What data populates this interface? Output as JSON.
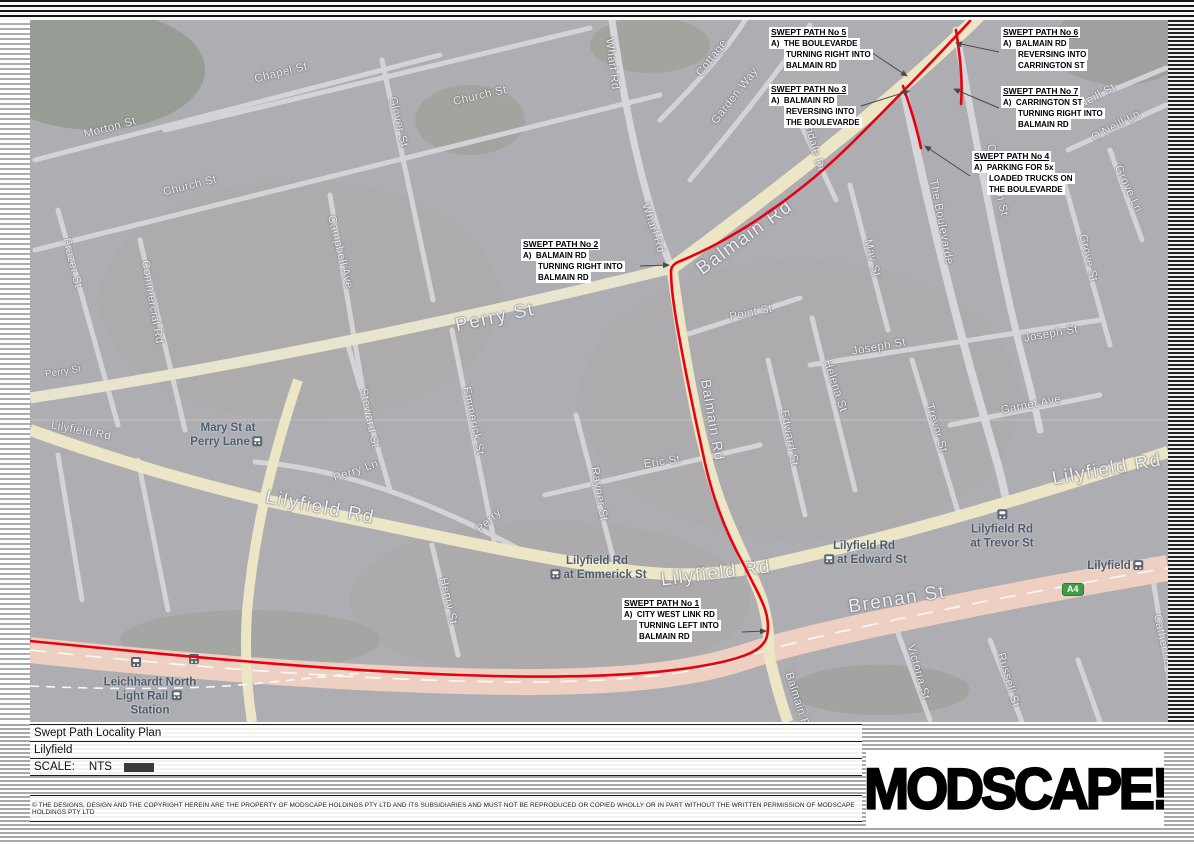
{
  "document": {
    "type_label": "Swept Path Locality Plan",
    "project": "Lilyfield",
    "scale_label": "SCALE:",
    "scale_value": "NTS",
    "disclaimer": "© THE DESIGNS, DESIGN AND THE COPYRIGHT HEREIN ARE THE PROPERTY OF MODSCAPE HOLDINGS PTY LTD AND ITS SUBSIDIARIES AND MUST NOT BE REPRODUCED OR COPIED WHOLLY OR IN PART WITHOUT THE WRITTEN PERMISSION OF MODSCAPE HOLDINGS PTY LTD",
    "logo_text": "MODSCAPE!"
  },
  "map": {
    "origin": {
      "x": 30,
      "y": 20
    },
    "colors": {
      "swept_path_red": "#e8000f",
      "main_road_yellow": "#ece6c6",
      "highway_pink": "#eed0c3",
      "minor_road": "#d6d6db",
      "station_slate": "#4d5d6e",
      "badge_green": "#3c9e47"
    },
    "route_badge": {
      "text": "A4",
      "x": 1062,
      "y": 583
    },
    "street_labels": [
      {
        "t": "Morton St",
        "x": 110,
        "y": 128,
        "r": -15,
        "cls": "md"
      },
      {
        "t": "Chapel St",
        "x": 281,
        "y": 73,
        "r": -14,
        "cls": "md"
      },
      {
        "t": "Church St",
        "x": 190,
        "y": 186,
        "r": -14,
        "cls": "md"
      },
      {
        "t": "Church St",
        "x": 480,
        "y": 96,
        "r": -13,
        "cls": "md"
      },
      {
        "t": "Glover St",
        "x": 398,
        "y": 122,
        "r": 76,
        "cls": "md"
      },
      {
        "t": "Frazer St",
        "x": 72,
        "y": 263,
        "r": 76,
        "cls": "md"
      },
      {
        "t": "Commercial Rd",
        "x": 152,
        "y": 302,
        "r": 80,
        "cls": "md"
      },
      {
        "t": "Campbell Ave",
        "x": 340,
        "y": 252,
        "r": 76,
        "cls": "md"
      },
      {
        "t": "Wharf Rd",
        "x": 612,
        "y": 64,
        "r": 83,
        "cls": "md"
      },
      {
        "t": "Wharf Rd",
        "x": 653,
        "y": 228,
        "r": 72,
        "cls": "md"
      },
      {
        "t": "Cottage",
        "x": 712,
        "y": 58,
        "r": -52,
        "cls": "md"
      },
      {
        "t": "Garden Way",
        "x": 735,
        "y": 96,
        "r": -52,
        "cls": "md"
      },
      {
        "t": "Glendale Dr",
        "x": 812,
        "y": 140,
        "r": 74,
        "cls": "md"
      },
      {
        "t": "Balmain Rd",
        "x": 745,
        "y": 238,
        "r": -36,
        "cls": "xl"
      },
      {
        "t": "Balmain Rd",
        "x": 713,
        "y": 420,
        "r": 80,
        "cls": "lg"
      },
      {
        "t": "Balmain Rd",
        "x": 798,
        "y": 703,
        "r": 72,
        "cls": "md"
      },
      {
        "t": "O'Neill St",
        "x": 1092,
        "y": 99,
        "r": -28,
        "cls": "md"
      },
      {
        "t": "O'Neill Ln",
        "x": 1116,
        "y": 126,
        "r": -28,
        "cls": "md"
      },
      {
        "t": "The Boulevarde",
        "x": 941,
        "y": 222,
        "r": 79,
        "cls": "md"
      },
      {
        "t": "Carrington St",
        "x": 997,
        "y": 180,
        "r": 79,
        "cls": "md"
      },
      {
        "t": "Grove Ln",
        "x": 1128,
        "y": 189,
        "r": 65,
        "cls": "md"
      },
      {
        "t": "Grove St",
        "x": 1088,
        "y": 258,
        "r": 76,
        "cls": "md"
      },
      {
        "t": "May St",
        "x": 872,
        "y": 258,
        "r": 76,
        "cls": "md"
      },
      {
        "t": "Point St",
        "x": 751,
        "y": 313,
        "r": -11,
        "cls": "md"
      },
      {
        "t": "Joseph St",
        "x": 879,
        "y": 347,
        "r": -10,
        "cls": "md"
      },
      {
        "t": "Joseph St",
        "x": 1051,
        "y": 334,
        "r": -10,
        "cls": "md"
      },
      {
        "t": "Helena St",
        "x": 835,
        "y": 386,
        "r": 72,
        "cls": "md"
      },
      {
        "t": "Edward St",
        "x": 789,
        "y": 438,
        "r": 79,
        "cls": "md"
      },
      {
        "t": "Trevor St",
        "x": 936,
        "y": 428,
        "r": 73,
        "cls": "md"
      },
      {
        "t": "Garnet Ave",
        "x": 1031,
        "y": 405,
        "r": -11,
        "cls": "md"
      },
      {
        "t": "Emmerick St",
        "x": 473,
        "y": 421,
        "r": 78,
        "cls": "md"
      },
      {
        "t": "Steward St",
        "x": 369,
        "y": 418,
        "r": 78,
        "cls": "md"
      },
      {
        "t": "Rayner St",
        "x": 599,
        "y": 494,
        "r": 80,
        "cls": "md"
      },
      {
        "t": "Eric St",
        "x": 662,
        "y": 462,
        "r": -8,
        "cls": "md"
      },
      {
        "t": "Henry St",
        "x": 448,
        "y": 601,
        "r": 77,
        "cls": "md"
      },
      {
        "t": "Perry St",
        "x": 495,
        "y": 318,
        "r": -12,
        "cls": "xl"
      },
      {
        "t": "Perry St",
        "x": 63,
        "y": 372,
        "r": -9,
        "cls": "sm"
      },
      {
        "t": "Perry Ln",
        "x": 356,
        "y": 471,
        "r": -19,
        "cls": "md"
      },
      {
        "t": "Perry",
        "x": 489,
        "y": 521,
        "r": -42,
        "cls": "md"
      },
      {
        "t": "Lilyfield Rd",
        "x": 81,
        "y": 431,
        "r": 11,
        "cls": "md"
      },
      {
        "t": "Lilyfield Rd",
        "x": 320,
        "y": 508,
        "r": 11,
        "cls": "xl"
      },
      {
        "t": "Lilyfield Rd",
        "x": 716,
        "y": 574,
        "r": -7,
        "cls": "xl"
      },
      {
        "t": "Lilyfield Rd",
        "x": 1107,
        "y": 470,
        "r": -10,
        "cls": "xl"
      },
      {
        "t": "Brenan St",
        "x": 897,
        "y": 600,
        "r": -9,
        "cls": "xl"
      },
      {
        "t": "Victoria St",
        "x": 918,
        "y": 672,
        "r": 74,
        "cls": "md"
      },
      {
        "t": "Russell St",
        "x": 1008,
        "y": 680,
        "r": 74,
        "cls": "md"
      },
      {
        "t": "Catherine St",
        "x": 1164,
        "y": 648,
        "r": 78,
        "cls": "md"
      }
    ],
    "station_labels": [
      {
        "lines": [
          "Mary St at",
          "Perry Lane"
        ],
        "x": 228,
        "y": 436,
        "icon": "right",
        "icon_line": 1
      },
      {
        "lines": [
          "Lilyfield Rd",
          "at Emmerick St"
        ],
        "x": 597,
        "y": 569,
        "icon": "left",
        "icon_line": 1
      },
      {
        "lines": [
          "Lilyfield Rd",
          "at Edward St"
        ],
        "x": 864,
        "y": 554,
        "icon": "left",
        "icon_line": 1
      },
      {
        "lines": [
          "Lilyfield Rd",
          "at Trevor St"
        ],
        "x": 1002,
        "y": 530,
        "icon": "above",
        "icon_line": 0
      },
      {
        "lines": [
          "Leichhardt North",
          "Light Rail",
          "Station"
        ],
        "x": 150,
        "y": 697,
        "icon": "right",
        "icon_line": 1
      },
      {
        "lines": [
          "Lilyfield"
        ],
        "x": 1117,
        "y": 567,
        "icon": "right",
        "icon_line": 0
      }
    ],
    "track_icons": [
      {
        "x": 128,
        "y": 657
      },
      {
        "x": 186,
        "y": 654
      }
    ],
    "swept_paths": [
      {
        "id": "swept-path-city-west-link-balmain",
        "d": "M30,641 C150,653 320,670 460,675 C570,679 660,676 722,662 C748,656 764,649 767,636 C772,612 757,593 745,567 C726,533 713,499 705,463 C697,426 688,386 680,341 C675,315 671,291 671,271 C671,267 674,264 678,262 C742,236 806,189 855,140 C894,101 934,60 970,21"
      },
      {
        "id": "swept-path-boulevarde",
        "d": "M903,86 C910,106 917,129 921,148"
      },
      {
        "id": "swept-path-carrington",
        "d": "M956,30 C960,56 963,81 961,104"
      }
    ],
    "callouts": [
      {
        "title": "SWEPT PATH No 1",
        "prefix": "A)",
        "lines": [
          "CITY WEST LINK RD",
          "TURNING LEFT INTO",
          "BALMAIN RD"
        ],
        "x": 622,
        "y": 598,
        "arrow": [
          742,
          632,
          766,
          631
        ]
      },
      {
        "title": "SWEPT PATH No 2",
        "prefix": "A)",
        "lines": [
          "BALMAIN RD",
          "TURNING RIGHT INTO",
          "BALMAIN RD"
        ],
        "x": 521,
        "y": 239,
        "arrow": [
          640,
          266,
          669,
          265
        ]
      },
      {
        "title": "SWEPT PATH No 3",
        "prefix": "A)",
        "lines": [
          "BALMAIN RD",
          "REVERSING INTO",
          "THE BOULEVARDE"
        ],
        "x": 769,
        "y": 84,
        "arrow": [
          861,
          106,
          909,
          91
        ]
      },
      {
        "title": "SWEPT PATH No 4",
        "prefix": "A)",
        "lines": [
          "PARKING FOR 5x",
          "LOADED TRUCKS ON",
          "THE BOULEVARDE"
        ],
        "x": 972,
        "y": 151,
        "arrow": [
          970,
          176,
          925,
          146
        ]
      },
      {
        "title": "SWEPT PATH No 5",
        "prefix": "A)",
        "lines": [
          "THE BOULEVARDE",
          "TURNING RIGHT INTO",
          "BALMAIN RD"
        ],
        "x": 769,
        "y": 27,
        "arrow": [
          871,
          52,
          907,
          76
        ]
      },
      {
        "title": "SWEPT PATH No 6",
        "prefix": "A)",
        "lines": [
          "BALMAIN RD",
          "REVERSING INTO",
          "CARRINGTON ST"
        ],
        "x": 1001,
        "y": 27,
        "arrow": [
          999,
          52,
          956,
          43
        ]
      },
      {
        "title": "SWEPT PATH No 7",
        "prefix": "A)",
        "lines": [
          "CARRINGTON ST",
          "TURNING RIGHT INTO",
          "BALMAIN RD"
        ],
        "x": 1001,
        "y": 86,
        "arrow": [
          999,
          108,
          954,
          89
        ]
      }
    ]
  }
}
